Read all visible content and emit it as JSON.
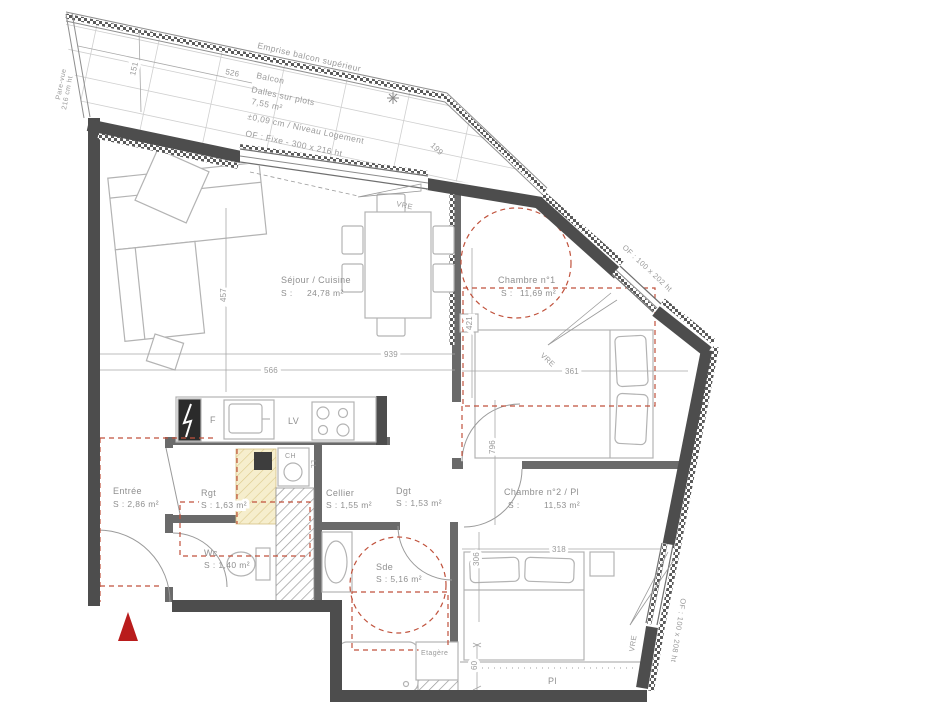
{
  "plan_title": "Plan d'appartement T3",
  "colors": {
    "wall": "#4d4d4d",
    "interior_wall": "#6a6a6a",
    "red_dashed": "#c0523c",
    "entrance_arrow": "#b91c1c",
    "closet_fill": "#f6eecd"
  },
  "balcony": {
    "emprise": "Emprise balcon supérieur",
    "name": "Balcon",
    "floor": "Dalles sur plots",
    "area": "7,55 m²",
    "level": "±0,09 cm / Niveau Logement",
    "window": "OF : Fixe - 300 x 216 ht",
    "pare_vue_1": "Pare-vue",
    "pare_vue_2": "216 cm ht"
  },
  "windows": {
    "vre": "VRE",
    "of_upper_right": "OF : 100 x 202 ht",
    "of_lower_right": "OF : 100 x 208 ht"
  },
  "rooms": {
    "sejour": {
      "name": "Séjour / Cuisine",
      "s": "S :",
      "area": "24,78 m²"
    },
    "chambre1": {
      "name": "Chambre n°1",
      "s": "S :",
      "area": "11,69 m²"
    },
    "chambre2": {
      "name": "Chambre n°2 / Pl",
      "s": "S :",
      "area": "11,53 m²"
    },
    "entree": {
      "name": "Entrée",
      "area": "S : 2,86 m²"
    },
    "rgt": {
      "name": "Rgt",
      "area": "S : 1,63 m²"
    },
    "wc": {
      "name": "Wc",
      "area": "S : 1,40 m²"
    },
    "cellier": {
      "name": "Cellier",
      "area": "S : 1,55 m²"
    },
    "dgt": {
      "name": "Dgt",
      "area": "S : 1,53 m²"
    },
    "sde": {
      "name": "Sde",
      "area": "S : 5,16 m²"
    },
    "etagere": "Etagère",
    "placard": "Pl"
  },
  "appliances": {
    "fridge": "F",
    "dishwasher": "LV",
    "boiler": "CH",
    "washer": "LL"
  },
  "dims": {
    "d526": "526",
    "d151": "151",
    "d199": "199",
    "d939": "939",
    "d566": "566",
    "d457": "457",
    "d421": "421",
    "d361": "361",
    "d796": "796",
    "d318": "318",
    "d306": "306",
    "d60": "60"
  }
}
